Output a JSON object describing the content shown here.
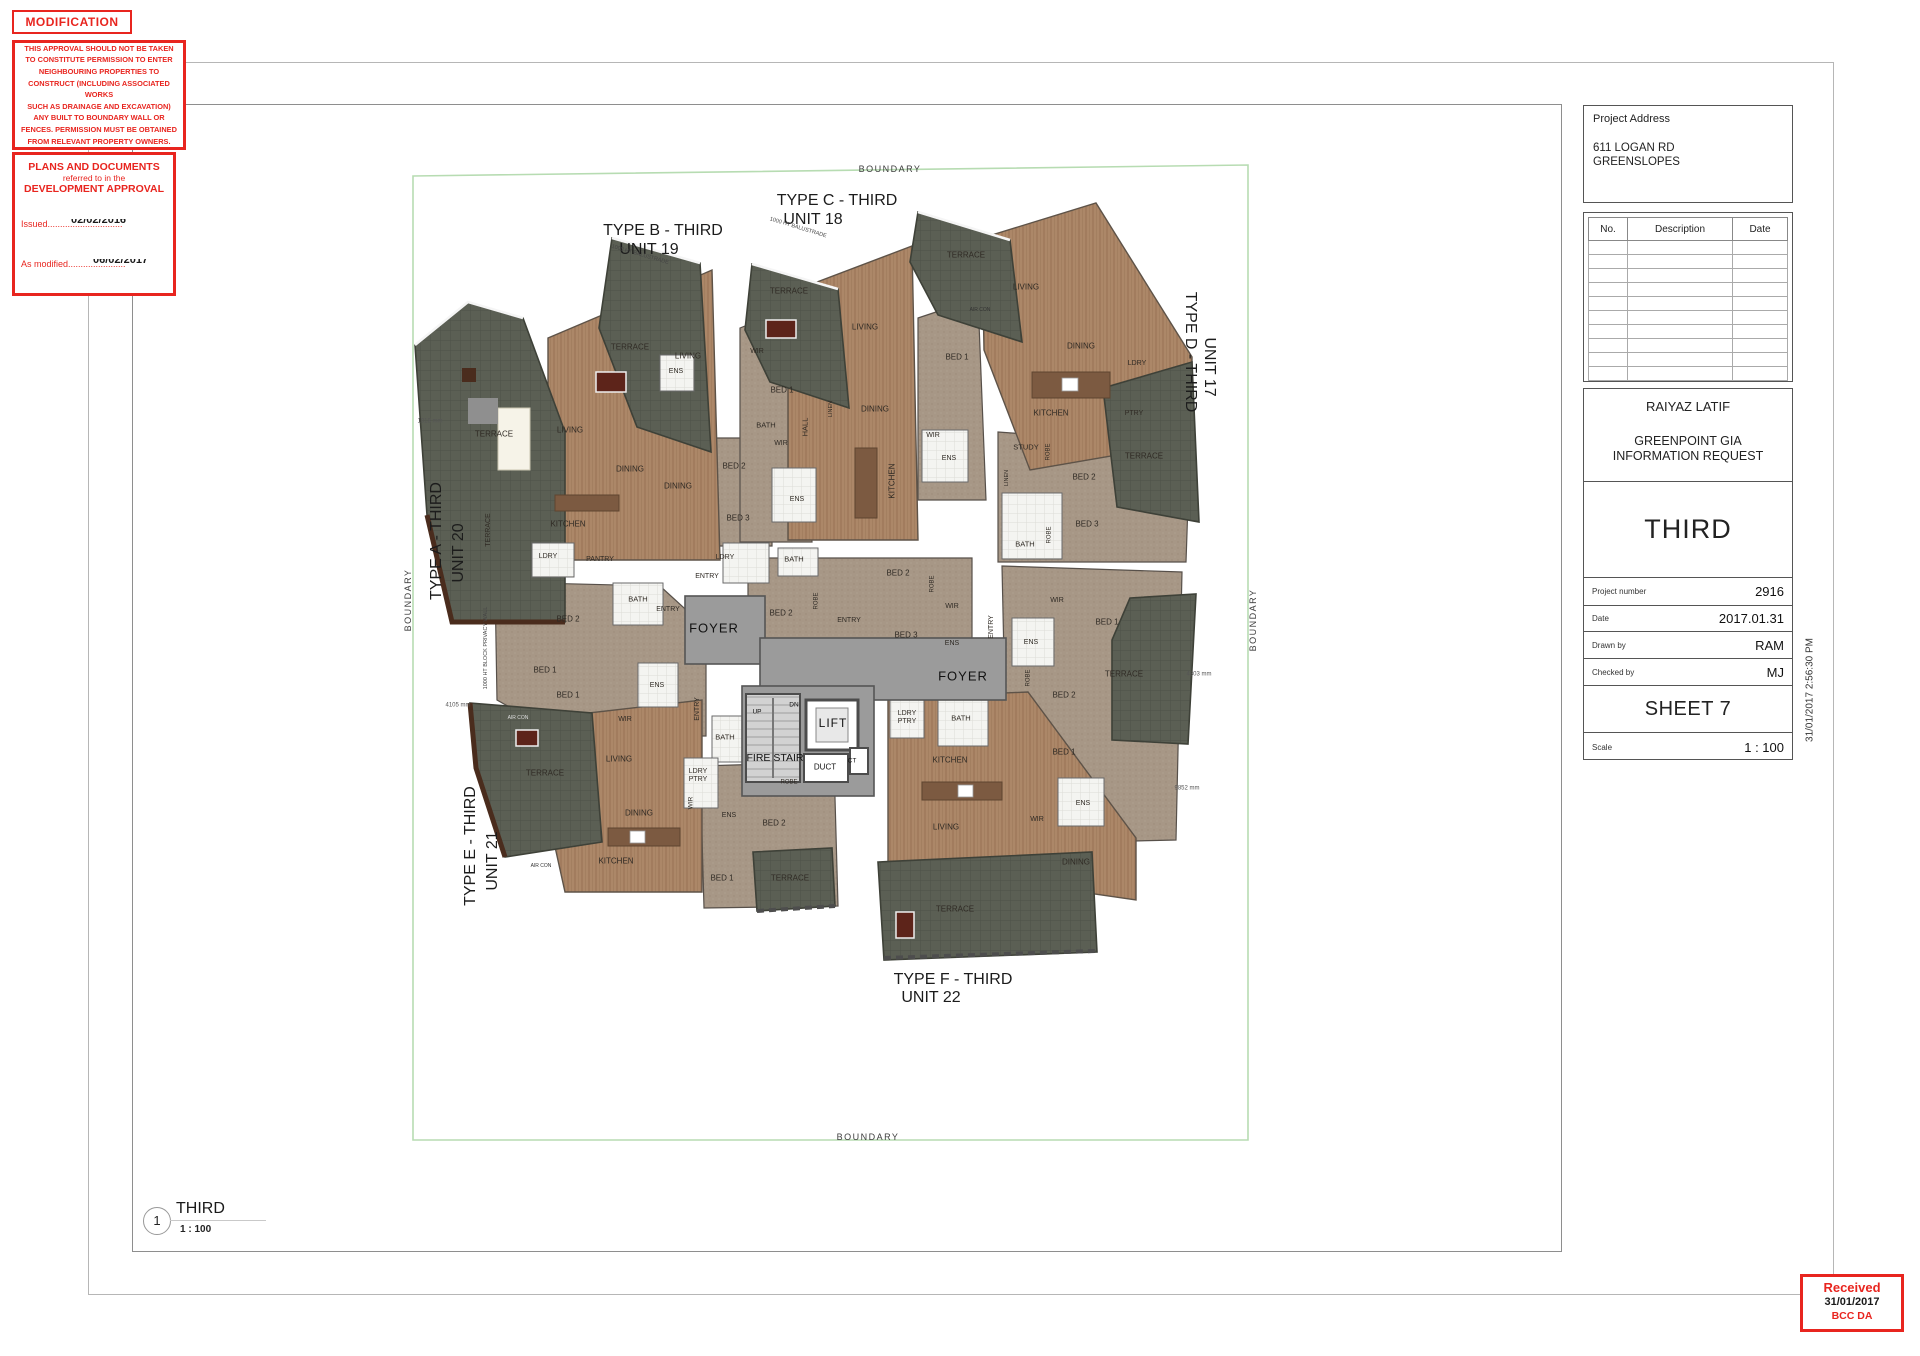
{
  "colors": {
    "stamp_red": "#e8251f",
    "boundary_green": "#b7dcb2",
    "wood_floor": "#ac8768",
    "deck_terrace": "#5b5f54",
    "carpet": "#a79786",
    "foyer_gray": "#9b9b9b",
    "wall": "#4c4c4c"
  },
  "stamps": {
    "modification": "MODIFICATION",
    "approval_lines": [
      "THIS APPROVAL SHOULD NOT BE TAKEN",
      "TO CONSTITUTE PERMISSION TO ENTER",
      "NEIGHBOURING PROPERTIES TO",
      "CONSTRUCT (INCLUDING ASSOCIATED WORKS",
      "SUCH AS DRAINAGE AND EXCAVATION)",
      "ANY BUILT TO BOUNDARY WALL OR",
      "FENCES. PERMISSION MUST BE OBTAINED",
      "FROM RELEVANT PROPERTY OWNERS."
    ],
    "plans_line1": "PLANS AND DOCUMENTS",
    "plans_line2": "referred to in the",
    "plans_line3": "DEVELOPMENT APPROVAL",
    "issued_label": "Issued",
    "issued_dots": "..............................",
    "issued_date": "02/02/2016",
    "modified_label": "As modified",
    "modified_dots": ".......................",
    "modified_date": "06/02/2017"
  },
  "title_block": {
    "address_label": "Project Address",
    "address_line1": "611 LOGAN RD",
    "address_line2": "GREENSLOPES",
    "author": "RAIYAZ LATIF",
    "project_line1": "GREENPOINT GIA",
    "project_line2": "INFORMATION REQUEST",
    "sheet_title": "THIRD",
    "project_number_label": "Project number",
    "project_number_value": "2916",
    "date_label": "Date",
    "date_value": "2017.01.31",
    "drawn_by_label": "Drawn by",
    "drawn_by_value": "RAM",
    "checked_by_label": "Checked by",
    "checked_by_value": "MJ",
    "sheet_number": "SHEET 7",
    "scale_label": "Scale",
    "scale_value": "1 : 100"
  },
  "revision_table": {
    "headers": [
      "No.",
      "Description",
      "Date"
    ],
    "empty_rows": 10
  },
  "timestamp_vertical": "31/01/2017 2:56:30 PM",
  "received_stamp": {
    "line1": "Received",
    "line2": "31/01/2017",
    "line3": "BCC DA"
  },
  "viewport_label": {
    "number": "1",
    "title": "THIRD",
    "scale": "1 : 100"
  },
  "plan": {
    "labels": [
      {
        "t": "TYPE B - THIRD",
        "x": 663,
        "y": 231,
        "s": 16,
        "c": "#1c1c1c"
      },
      {
        "t": "UNIT 19",
        "x": 649,
        "y": 250,
        "s": 16,
        "c": "#1c1c1c"
      },
      {
        "t": "TYPE C - THIRD",
        "x": 837,
        "y": 201,
        "s": 16,
        "c": "#1c1c1c"
      },
      {
        "t": "UNIT 18",
        "x": 813,
        "y": 220,
        "s": 16,
        "c": "#1c1c1c"
      },
      {
        "t": "TYPE D - THIRD",
        "x": 1190,
        "y": 352,
        "s": 16,
        "r": 90,
        "c": "#1c1c1c"
      },
      {
        "t": "UNIT 17",
        "x": 1209,
        "y": 367,
        "s": 16,
        "r": 90,
        "c": "#1c1c1c"
      },
      {
        "t": "TYPE A - THIRD",
        "x": 437,
        "y": 541,
        "s": 16,
        "r": -90,
        "c": "#1c1c1c"
      },
      {
        "t": "UNIT 20",
        "x": 459,
        "y": 553,
        "s": 16,
        "r": -90,
        "c": "#1c1c1c"
      },
      {
        "t": "TYPE E - THIRD",
        "x": 471,
        "y": 846,
        "s": 16,
        "r": -90,
        "c": "#1c1c1c"
      },
      {
        "t": "UNIT 21",
        "x": 493,
        "y": 861,
        "s": 16,
        "r": -90,
        "c": "#1c1c1c"
      },
      {
        "t": "TYPE F - THIRD",
        "x": 953,
        "y": 980,
        "s": 16,
        "c": "#1c1c1c"
      },
      {
        "t": "UNIT 22",
        "x": 931,
        "y": 998,
        "s": 16,
        "c": "#1c1c1c"
      },
      {
        "t": "BOUNDARY",
        "x": 890,
        "y": 169,
        "s": 9,
        "ls": 1.5,
        "c": "#3c3c3c"
      },
      {
        "t": "BOUNDARY",
        "x": 868,
        "y": 1137,
        "s": 9,
        "ls": 1.5,
        "c": "#3c3c3c"
      },
      {
        "t": "BOUNDARY",
        "x": 408,
        "y": 600,
        "s": 9,
        "r": -90,
        "ls": 1.5,
        "c": "#3c3c3c"
      },
      {
        "t": "BOUNDARY",
        "x": 1253,
        "y": 620,
        "s": 9,
        "r": -90,
        "ls": 1.5,
        "c": "#3c3c3c"
      },
      {
        "t": "FOYER",
        "x": 714,
        "y": 629,
        "s": 13,
        "ls": 1,
        "c": "#111"
      },
      {
        "t": "FOYER",
        "x": 963,
        "y": 677,
        "s": 13,
        "ls": 1,
        "c": "#111"
      },
      {
        "t": "LIFT",
        "x": 833,
        "y": 724,
        "s": 12,
        "ls": 1,
        "c": "#111"
      },
      {
        "t": "FIRE STAIR",
        "x": 775,
        "y": 758,
        "s": 10.5,
        "c": "#111"
      },
      {
        "t": "DUCT",
        "x": 825,
        "y": 767,
        "s": 8,
        "c": "#111"
      },
      {
        "t": "CT",
        "x": 852,
        "y": 761,
        "s": 6.5,
        "c": "#111"
      },
      {
        "t": "UP",
        "x": 757,
        "y": 712,
        "s": 6.5,
        "c": "#111"
      },
      {
        "t": "DN",
        "x": 794,
        "y": 705,
        "s": 6.5,
        "c": "#111"
      },
      {
        "t": "TERRACE",
        "x": 494,
        "y": 434
      },
      {
        "t": "TERRACE",
        "x": 630,
        "y": 347
      },
      {
        "t": "TERRACE",
        "x": 789,
        "y": 291
      },
      {
        "t": "TERRACE",
        "x": 966,
        "y": 255
      },
      {
        "t": "TERRACE",
        "x": 1144,
        "y": 456
      },
      {
        "t": "TERRACE",
        "x": 1124,
        "y": 674
      },
      {
        "t": "TERRACE",
        "x": 545,
        "y": 773
      },
      {
        "t": "TERRACE",
        "x": 955,
        "y": 909
      },
      {
        "t": "TERRACE",
        "x": 790,
        "y": 878
      },
      {
        "t": "TERRACE",
        "x": 489,
        "y": 530,
        "s": 7,
        "r": -90
      },
      {
        "t": "LIVING",
        "x": 570,
        "y": 430
      },
      {
        "t": "LIVING",
        "x": 688,
        "y": 356
      },
      {
        "t": "LIVING",
        "x": 865,
        "y": 327
      },
      {
        "t": "LIVING",
        "x": 1026,
        "y": 287
      },
      {
        "t": "LIVING",
        "x": 619,
        "y": 759
      },
      {
        "t": "LIVING",
        "x": 946,
        "y": 827
      },
      {
        "t": "DINING",
        "x": 630,
        "y": 469
      },
      {
        "t": "DINING",
        "x": 678,
        "y": 486
      },
      {
        "t": "DINING",
        "x": 875,
        "y": 409
      },
      {
        "t": "DINING",
        "x": 1081,
        "y": 346
      },
      {
        "t": "DINING",
        "x": 639,
        "y": 813
      },
      {
        "t": "DINING",
        "x": 1076,
        "y": 862
      },
      {
        "t": "KITCHEN",
        "x": 568,
        "y": 524
      },
      {
        "t": "KITCHEN",
        "x": 1051,
        "y": 413
      },
      {
        "t": "KITCHEN",
        "x": 950,
        "y": 760
      },
      {
        "t": "KITCHEN",
        "x": 616,
        "y": 861
      },
      {
        "t": "KITCHEN",
        "x": 892,
        "y": 481,
        "r": -90
      },
      {
        "t": "BED 1",
        "x": 782,
        "y": 390
      },
      {
        "t": "BED 1",
        "x": 957,
        "y": 357
      },
      {
        "t": "BED 1",
        "x": 545,
        "y": 670
      },
      {
        "t": "BED 1",
        "x": 568,
        "y": 695
      },
      {
        "t": "BED 1",
        "x": 1107,
        "y": 622
      },
      {
        "t": "BED 1",
        "x": 1064,
        "y": 752
      },
      {
        "t": "BED 1",
        "x": 722,
        "y": 878
      },
      {
        "t": "BED 2",
        "x": 568,
        "y": 619
      },
      {
        "t": "BED 2",
        "x": 734,
        "y": 466
      },
      {
        "t": "BED 2",
        "x": 898,
        "y": 573
      },
      {
        "t": "BED 2",
        "x": 781,
        "y": 613
      },
      {
        "t": "BED 2",
        "x": 1084,
        "y": 477
      },
      {
        "t": "BED 2",
        "x": 1064,
        "y": 695
      },
      {
        "t": "BED 2",
        "x": 774,
        "y": 823
      },
      {
        "t": "BED 3",
        "x": 738,
        "y": 518
      },
      {
        "t": "BED 3",
        "x": 906,
        "y": 635
      },
      {
        "t": "BED 3",
        "x": 1087,
        "y": 524
      },
      {
        "t": "WIR",
        "x": 757,
        "y": 352,
        "s": 7
      },
      {
        "t": "WIR",
        "x": 781,
        "y": 444,
        "s": 7
      },
      {
        "t": "WIR",
        "x": 933,
        "y": 436,
        "s": 7
      },
      {
        "t": "WIR",
        "x": 952,
        "y": 607,
        "s": 7
      },
      {
        "t": "WIR",
        "x": 1057,
        "y": 601,
        "s": 7
      },
      {
        "t": "WIR",
        "x": 625,
        "y": 720,
        "s": 7
      },
      {
        "t": "WIR",
        "x": 1037,
        "y": 820,
        "s": 7
      },
      {
        "t": "WIR",
        "x": 691,
        "y": 803,
        "s": 6.5,
        "r": -90
      },
      {
        "t": "ENS",
        "x": 676,
        "y": 372,
        "s": 7
      },
      {
        "t": "ENS",
        "x": 797,
        "y": 500,
        "s": 7
      },
      {
        "t": "ENS",
        "x": 949,
        "y": 459,
        "s": 7
      },
      {
        "t": "ENS",
        "x": 952,
        "y": 644,
        "s": 7
      },
      {
        "t": "ENS",
        "x": 1031,
        "y": 643,
        "s": 7
      },
      {
        "t": "ENS",
        "x": 657,
        "y": 686,
        "s": 7
      },
      {
        "t": "ENS",
        "x": 729,
        "y": 816,
        "s": 7
      },
      {
        "t": "ENS",
        "x": 1083,
        "y": 804,
        "s": 7
      },
      {
        "t": "BATH",
        "x": 766,
        "y": 426,
        "s": 7.5
      },
      {
        "t": "BATH",
        "x": 638,
        "y": 600,
        "s": 7.5
      },
      {
        "t": "BATH",
        "x": 794,
        "y": 560,
        "s": 7.5
      },
      {
        "t": "BATH",
        "x": 725,
        "y": 738,
        "s": 7.5
      },
      {
        "t": "BATH",
        "x": 1025,
        "y": 545,
        "s": 7.5
      },
      {
        "t": "BATH",
        "x": 961,
        "y": 719,
        "s": 7.5
      },
      {
        "t": "LDRY",
        "x": 548,
        "y": 557,
        "s": 7
      },
      {
        "t": "LDRY",
        "x": 725,
        "y": 558,
        "s": 7
      },
      {
        "t": "LDRY",
        "x": 1137,
        "y": 364,
        "s": 7
      },
      {
        "t": "LDRY\nPTRY",
        "x": 698,
        "y": 776,
        "s": 7
      },
      {
        "t": "LDRY\nPTRY",
        "x": 907,
        "y": 718,
        "s": 7
      },
      {
        "t": "PANTRY",
        "x": 600,
        "y": 560,
        "s": 7
      },
      {
        "t": "PTRY",
        "x": 1134,
        "y": 414,
        "s": 7
      },
      {
        "t": "STUDY",
        "x": 1026,
        "y": 448,
        "s": 7.5
      },
      {
        "t": "ENTRY",
        "x": 668,
        "y": 610,
        "s": 7
      },
      {
        "t": "ENTRY",
        "x": 707,
        "y": 577,
        "s": 7
      },
      {
        "t": "ENTRY",
        "x": 849,
        "y": 621,
        "s": 7
      },
      {
        "t": "ENTRY",
        "x": 698,
        "y": 709,
        "s": 7,
        "r": -90
      },
      {
        "t": "ENTRY",
        "x": 992,
        "y": 627,
        "s": 7,
        "r": -90
      },
      {
        "t": "ROBE",
        "x": 817,
        "y": 601,
        "s": 6,
        "r": -90
      },
      {
        "t": "ROBE",
        "x": 933,
        "y": 584,
        "s": 6,
        "r": -90
      },
      {
        "t": "ROBE",
        "x": 1049,
        "y": 452,
        "s": 6,
        "r": -90
      },
      {
        "t": "ROBE",
        "x": 1050,
        "y": 535,
        "s": 6,
        "r": -90
      },
      {
        "t": "ROBE",
        "x": 1029,
        "y": 678,
        "s": 6,
        "r": -90
      },
      {
        "t": "ROBE",
        "x": 789,
        "y": 783,
        "s": 6
      },
      {
        "t": "LINEN",
        "x": 1007,
        "y": 478,
        "s": 5.5,
        "r": -90
      },
      {
        "t": "LINEN",
        "x": 831,
        "y": 409,
        "s": 5.5,
        "r": -90
      },
      {
        "t": "HALL",
        "x": 806,
        "y": 427,
        "s": 7.5,
        "r": -90
      },
      {
        "t": "AIR CON",
        "x": 518,
        "y": 719,
        "s": 5,
        "c": "#ddd"
      },
      {
        "t": "AIR CON",
        "x": 541,
        "y": 867,
        "s": 5,
        "c": "#333"
      },
      {
        "t": "AIR CON",
        "x": 980,
        "y": 311,
        "s": 5,
        "c": "#333"
      },
      {
        "t": "1000 HT BALUSTRADE",
        "x": 640,
        "y": 255,
        "s": 5.5,
        "r": 16,
        "c": "#444"
      },
      {
        "t": "1000 HT BALUSTRADE",
        "x": 798,
        "y": 228,
        "s": 5.5,
        "r": 17,
        "c": "#444"
      },
      {
        "t": "1000 HT BLOCK PRIVACY WALL",
        "x": 486,
        "y": 648,
        "s": 5.5,
        "r": -90,
        "c": "#444"
      },
      {
        "t": "1018 mm",
        "x": 430,
        "y": 422,
        "s": 6,
        "c": "#555"
      },
      {
        "t": "4105 mm",
        "x": 458,
        "y": 706,
        "s": 6,
        "c": "#555"
      },
      {
        "t": "4803 mm",
        "x": 1199,
        "y": 675,
        "s": 6,
        "c": "#555"
      },
      {
        "t": "9852 mm",
        "x": 1187,
        "y": 789,
        "s": 6,
        "c": "#555"
      }
    ]
  }
}
